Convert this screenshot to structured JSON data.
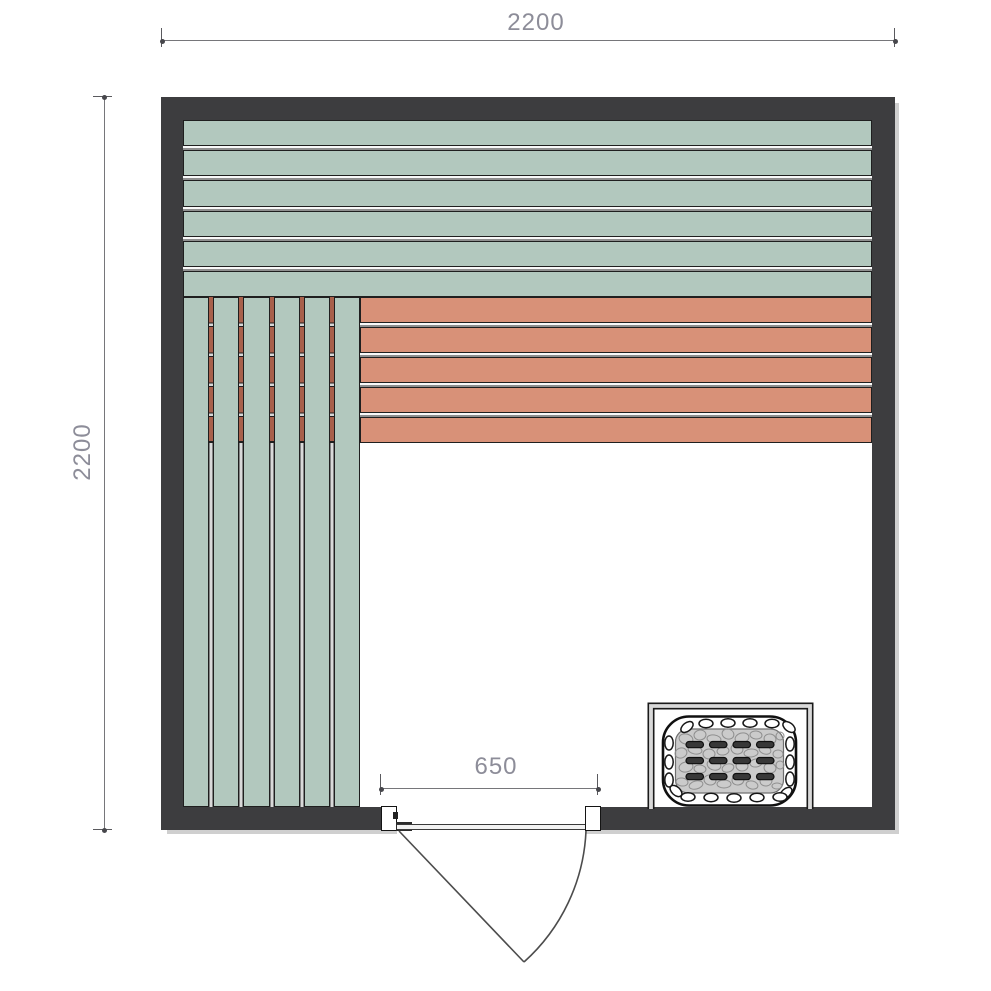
{
  "drawing": {
    "name": "sauna-floor-plan",
    "dimensions": {
      "overall_width": "2200",
      "overall_depth": "2200",
      "door_width": "650"
    },
    "colors": {
      "wall": "#3d3d3f",
      "bench_top_seat": "#b2c8be",
      "bench_upper_seat": "#d89178",
      "bench_under_gap": "#a8604b",
      "dimension_text": "#8d8d99",
      "dimension_line": "#76767a",
      "heater_stones": "#cbcbcb"
    },
    "benches": {
      "back_bench": {
        "plank_count": 6,
        "orientation": "horizontal"
      },
      "upper_bench": {
        "plank_count": 5,
        "orientation": "horizontal"
      },
      "side_bench": {
        "plank_count": 6,
        "orientation": "vertical"
      }
    },
    "heater": {
      "slot_columns": 4,
      "slot_rows": 3
    }
  }
}
